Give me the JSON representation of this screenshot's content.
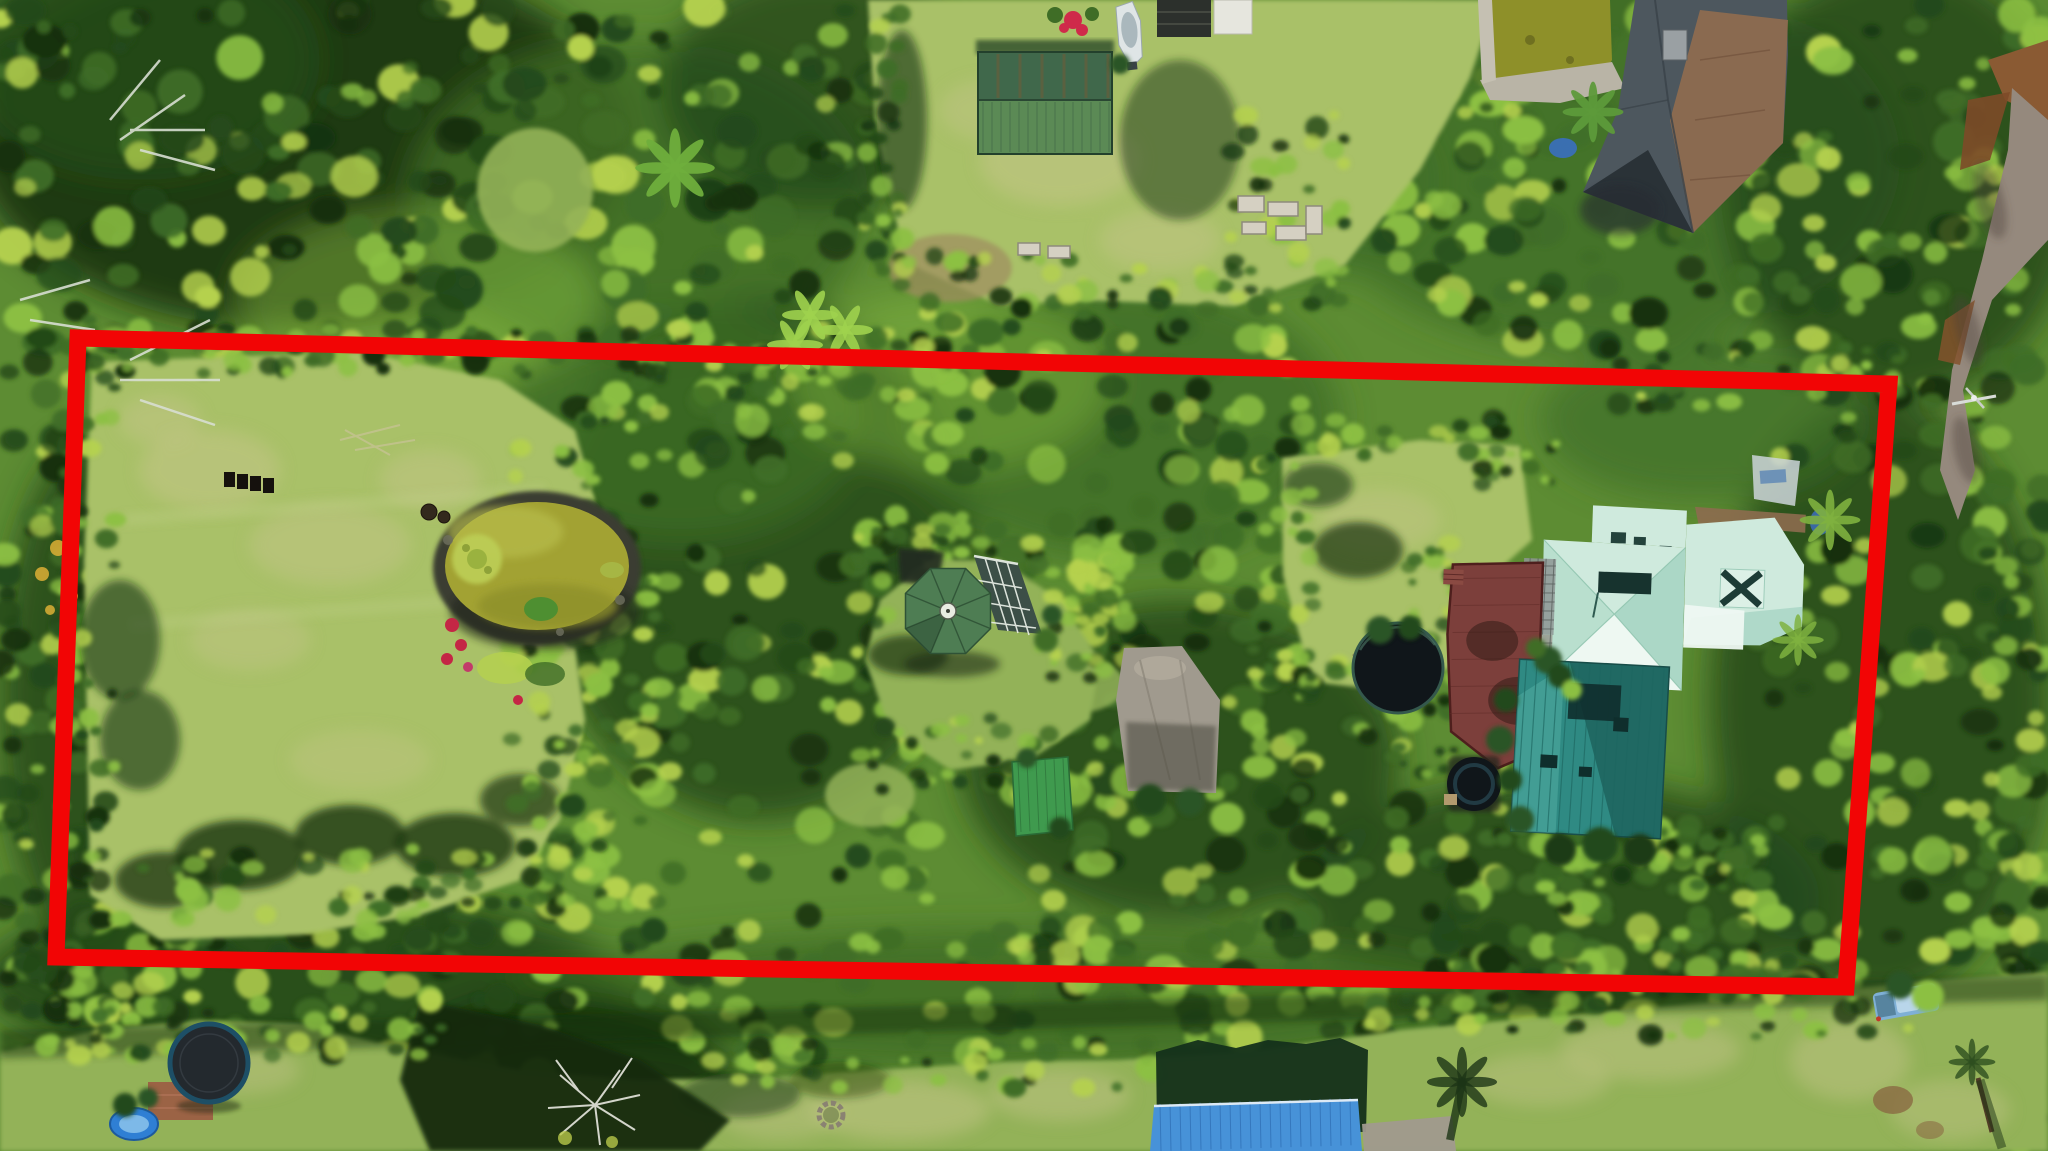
{
  "meta": {
    "width": 2048,
    "height": 1151,
    "kind": "aerial-drone-photograph"
  },
  "scene": {
    "title": "Aerial view of a wooded tropical property outlined with a red lot boundary",
    "description": "Top-down drone photo of a long rectangular lot ringed by dense tropical forest. Inside the red outline: a large mowed lawn, a koi pond with rock border, an octagonal green-roof gazebo with attached glass conservatory, a concrete pad, and a main residence with pale seafoam hip roofs, a teal metal wing, maroon deck, round black pool and hot tub. Neighboring yards show a green metal shed, a boat, a weathered hip-roof house with its own pond, raised garden beds, a gravel road on the right, and at bottom a trampoline, blue kiddie pool, fire ring and a blue metal-roof outbuilding.",
    "annotation": {
      "type": "property-boundary",
      "shape": "rotated-rectangle",
      "color": "#f20505",
      "stroke_px": 17
    },
    "palette": {
      "boundary_red": "#f20505",
      "canopy_base": "#5d8c33",
      "forest_deep": "#16300f",
      "forest_dark": "#24491a",
      "forest_mid": "#3f6d26",
      "foliage_bright": "#8cc043",
      "foliage_lime": "#b5d14e",
      "lawn_light": "#a9c168",
      "lawn_mid": "#93b258",
      "lawn_tan": "#c6c68a",
      "shadow_green": "#18320f",
      "pond_water": "#a2a233",
      "pond_water_dark": "#8e9029",
      "stone_dark": "#3a3d33",
      "concrete": "#a09a8e",
      "road_gray": "#95897d",
      "dirt_brown": "#8a5a33",
      "roof_mint": "#cfeadd",
      "roof_mint_shade": "#abd7c6",
      "roof_white": "#eef8f2",
      "roof_teal": "#2f8a83",
      "roof_teal_dark": "#1a524f",
      "deck_maroon": "#7c3f3b",
      "roof_gray": "#4d575e",
      "roof_brown": "#8d6b4f",
      "shed_green": "#40684b",
      "shed_green_bright": "#5b8a55",
      "gazebo_green": "#4e7d53",
      "glass_dark": "#3c4f47",
      "blue_roof": "#4792d8",
      "black_pool": "#10161a",
      "trampoline_black": "#23292e",
      "water_blue": "#2f7fd4",
      "white": "#f2f5ef",
      "boat_white": "#dfe5e6",
      "truck_blue": "#7fb0d6"
    },
    "objects": [
      {
        "id": "boundary",
        "label": "Red property boundary outline"
      },
      {
        "id": "main-house",
        "label": "Main residence with seafoam hip roof and teal metal wing"
      },
      {
        "id": "gazebo",
        "label": "Octagonal green-roof gazebo with glass conservatory"
      },
      {
        "id": "pond",
        "label": "Koi pond with rock border and lily pads"
      },
      {
        "id": "left-lawn",
        "label": "Large mowed lawn"
      },
      {
        "id": "neighbor-house",
        "label": "Neighboring house with weathered hip roof and pond"
      },
      {
        "id": "shed",
        "label": "Green metal equipment shed"
      },
      {
        "id": "boat",
        "label": "White boat parked on grass"
      },
      {
        "id": "round-pool",
        "label": "Round above-ground pool"
      },
      {
        "id": "hot-tub",
        "label": "Round hot tub beside deck"
      },
      {
        "id": "concrete-pad",
        "label": "Concrete parking pad"
      },
      {
        "id": "trampoline",
        "label": "Backyard trampoline on brick pad"
      },
      {
        "id": "kiddie-pool",
        "label": "Blue inflatable kiddie pool"
      },
      {
        "id": "blue-building",
        "label": "Outbuilding with blue metal roof"
      },
      {
        "id": "truck",
        "label": "Light blue pickup truck"
      },
      {
        "id": "road",
        "label": "Gravel road along right edge"
      },
      {
        "id": "fire-ring",
        "label": "Stone fire ring in lawn"
      },
      {
        "id": "garden",
        "label": "Raised garden beds"
      }
    ]
  }
}
